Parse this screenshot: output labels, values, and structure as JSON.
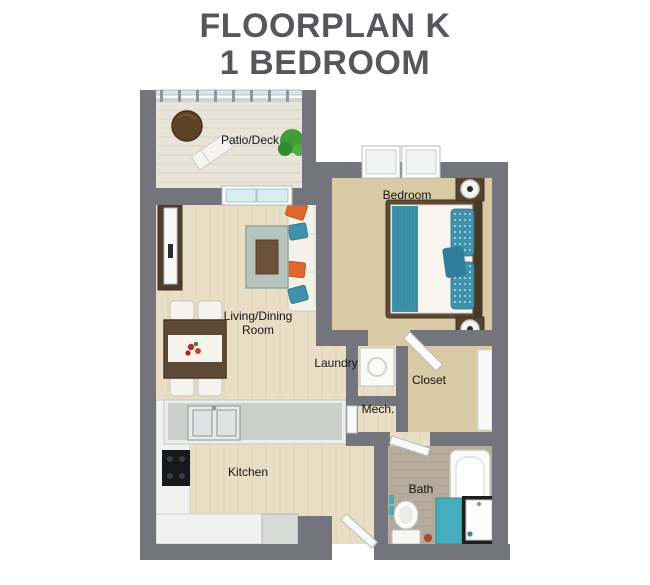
{
  "title": {
    "line1": "FLOORPLAN K",
    "line2": "1 BEDROOM"
  },
  "rooms": {
    "patio": {
      "label": "Patio/Deck"
    },
    "bedroom": {
      "label": "Bedroom"
    },
    "living": {
      "label_line1": "Living/Dining",
      "label_line2": "Room"
    },
    "laundry": {
      "label": "Laundry"
    },
    "mech": {
      "label": "Mech."
    },
    "closet": {
      "label": "Closet"
    },
    "kitchen": {
      "label": "Kitchen"
    },
    "bath": {
      "label": "Bath"
    }
  },
  "colors": {
    "wall": "#74747C",
    "floor_wood": "#E8DEC5",
    "floor_patio": "#E9E4D8",
    "floor_carpet": "#D7CAA5",
    "floor_tile": "#B5AC9D",
    "teal": "#45AEBE",
    "teal_deep": "#3E92AC",
    "teal_dark": "#2F7F9B",
    "orange": "#E0662B",
    "wood_dark": "#5E4A36",
    "title_gray": "#56575A"
  }
}
